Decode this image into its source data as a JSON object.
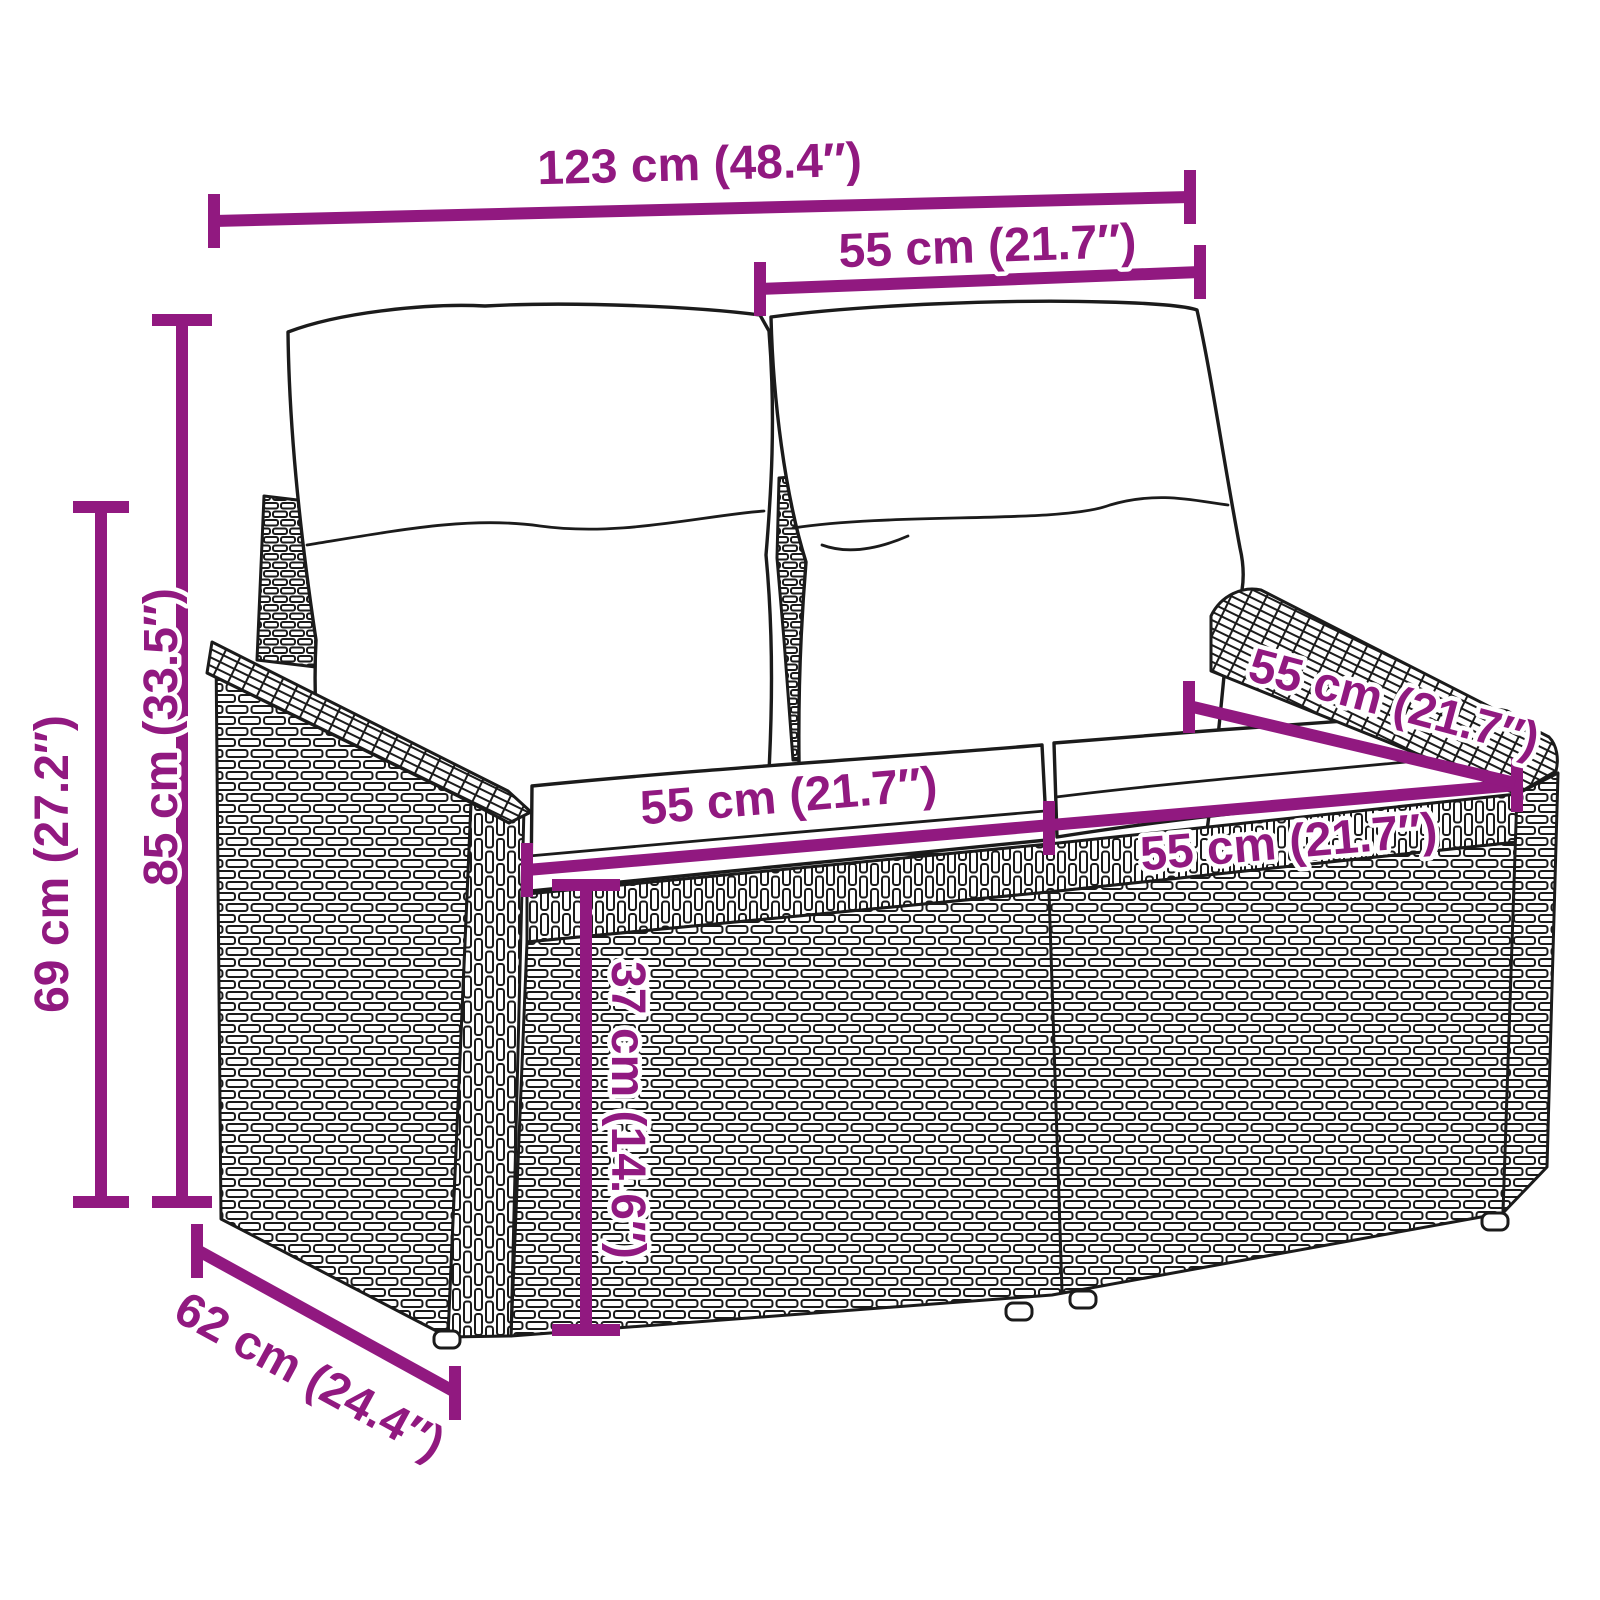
{
  "diagram": {
    "figure": "two-seater-poly-rattan-garden-sofa-line-drawing",
    "accent_color": "#911980",
    "line_color": "#1b1b1b",
    "background_color": "#ffffff",
    "measurements": {
      "overall_width": "123 cm (48.4″)",
      "back_width": "55 cm (21.7″)",
      "total_height": "85 cm (33.5″)",
      "armrest_height": "69 cm (27.2″)",
      "seat_width_left": "55 cm (21.7″)",
      "seat_width_right": "55 cm (21.7″)",
      "seat_depth": "55 cm (21.7″)",
      "seat_height": "37 cm (14.6″)",
      "overall_depth": "62 cm (24.4″)"
    }
  }
}
